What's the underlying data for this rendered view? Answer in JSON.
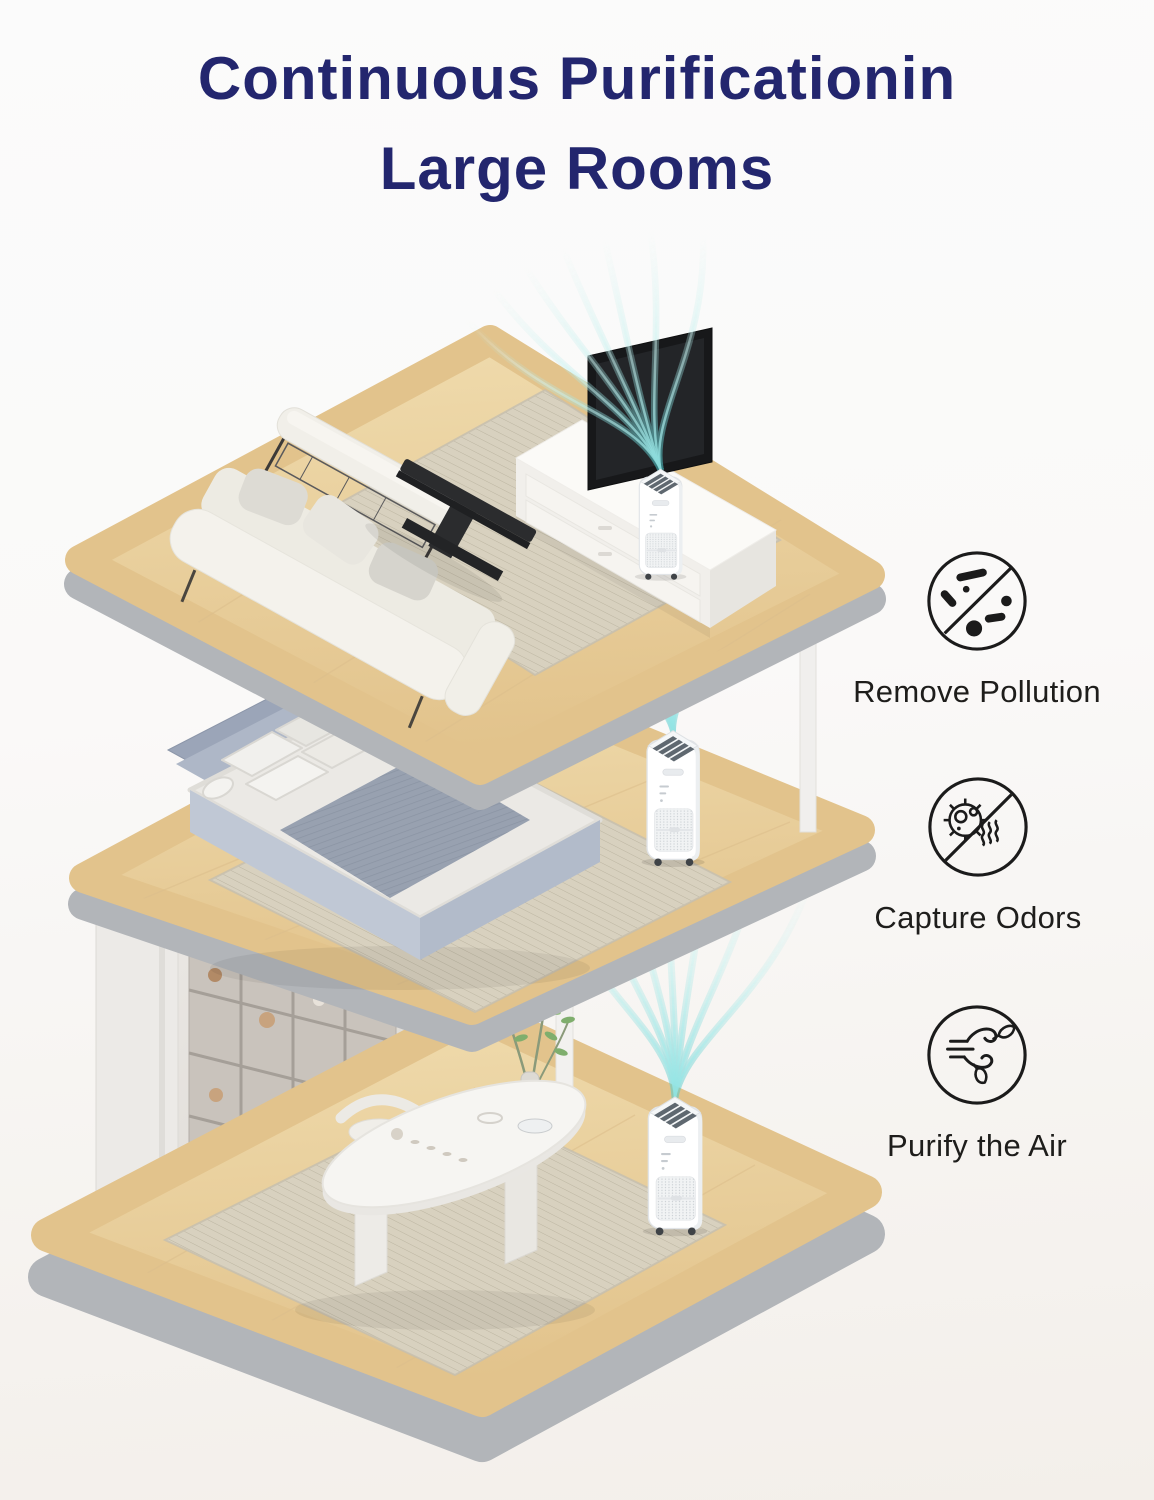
{
  "title": {
    "line1": "Continuous Purificationin",
    "line2": "Large Rooms"
  },
  "features": [
    {
      "label": "Remove Pollution",
      "icon": "crossed-pollution-particles-icon"
    },
    {
      "label": "Capture Odors",
      "icon": "crossed-odor-germ-icon"
    },
    {
      "label": "Purify the Air",
      "icon": "wind-leaves-icon"
    }
  ],
  "scenes": [
    {
      "room": "living room",
      "objects": [
        "white sofa with pillows",
        "upholstered bench",
        "metal shelf",
        "black coffee table",
        "tv stand with drawers",
        "tv",
        "area rug",
        "air purifier",
        "cyan airflow stream"
      ]
    },
    {
      "room": "bedroom",
      "objects": [
        "grey upholstered bed",
        "white and patterned pillows",
        "striped blanket",
        "area rug",
        "air purifier",
        "cyan airflow stream"
      ]
    },
    {
      "room": "tea room",
      "objects": [
        "wall shelving with teaware",
        "white pillar",
        "marble dining table",
        "tea set",
        "chair",
        "potted plant",
        "area rug",
        "air purifier",
        "cyan airflow stream"
      ]
    }
  ],
  "colors": {
    "background_top": "#FBFBFB",
    "background_bottom": "#F3EFEA",
    "title_text": "#23266E",
    "label_text": "#1E1D1B",
    "icon_stroke": "#1B1B1B",
    "air_stream": "#4FCBCE",
    "air_stream_light": "#B5ECEA",
    "wood_light": "#F0DCAE",
    "wood_dark": "#E2C38C",
    "platform_edge": "#B2B5B9",
    "rug": "#D8D1BF",
    "purifier_white": "#FFFFFF",
    "accent_dark_furniture": "#2B2C2E"
  }
}
